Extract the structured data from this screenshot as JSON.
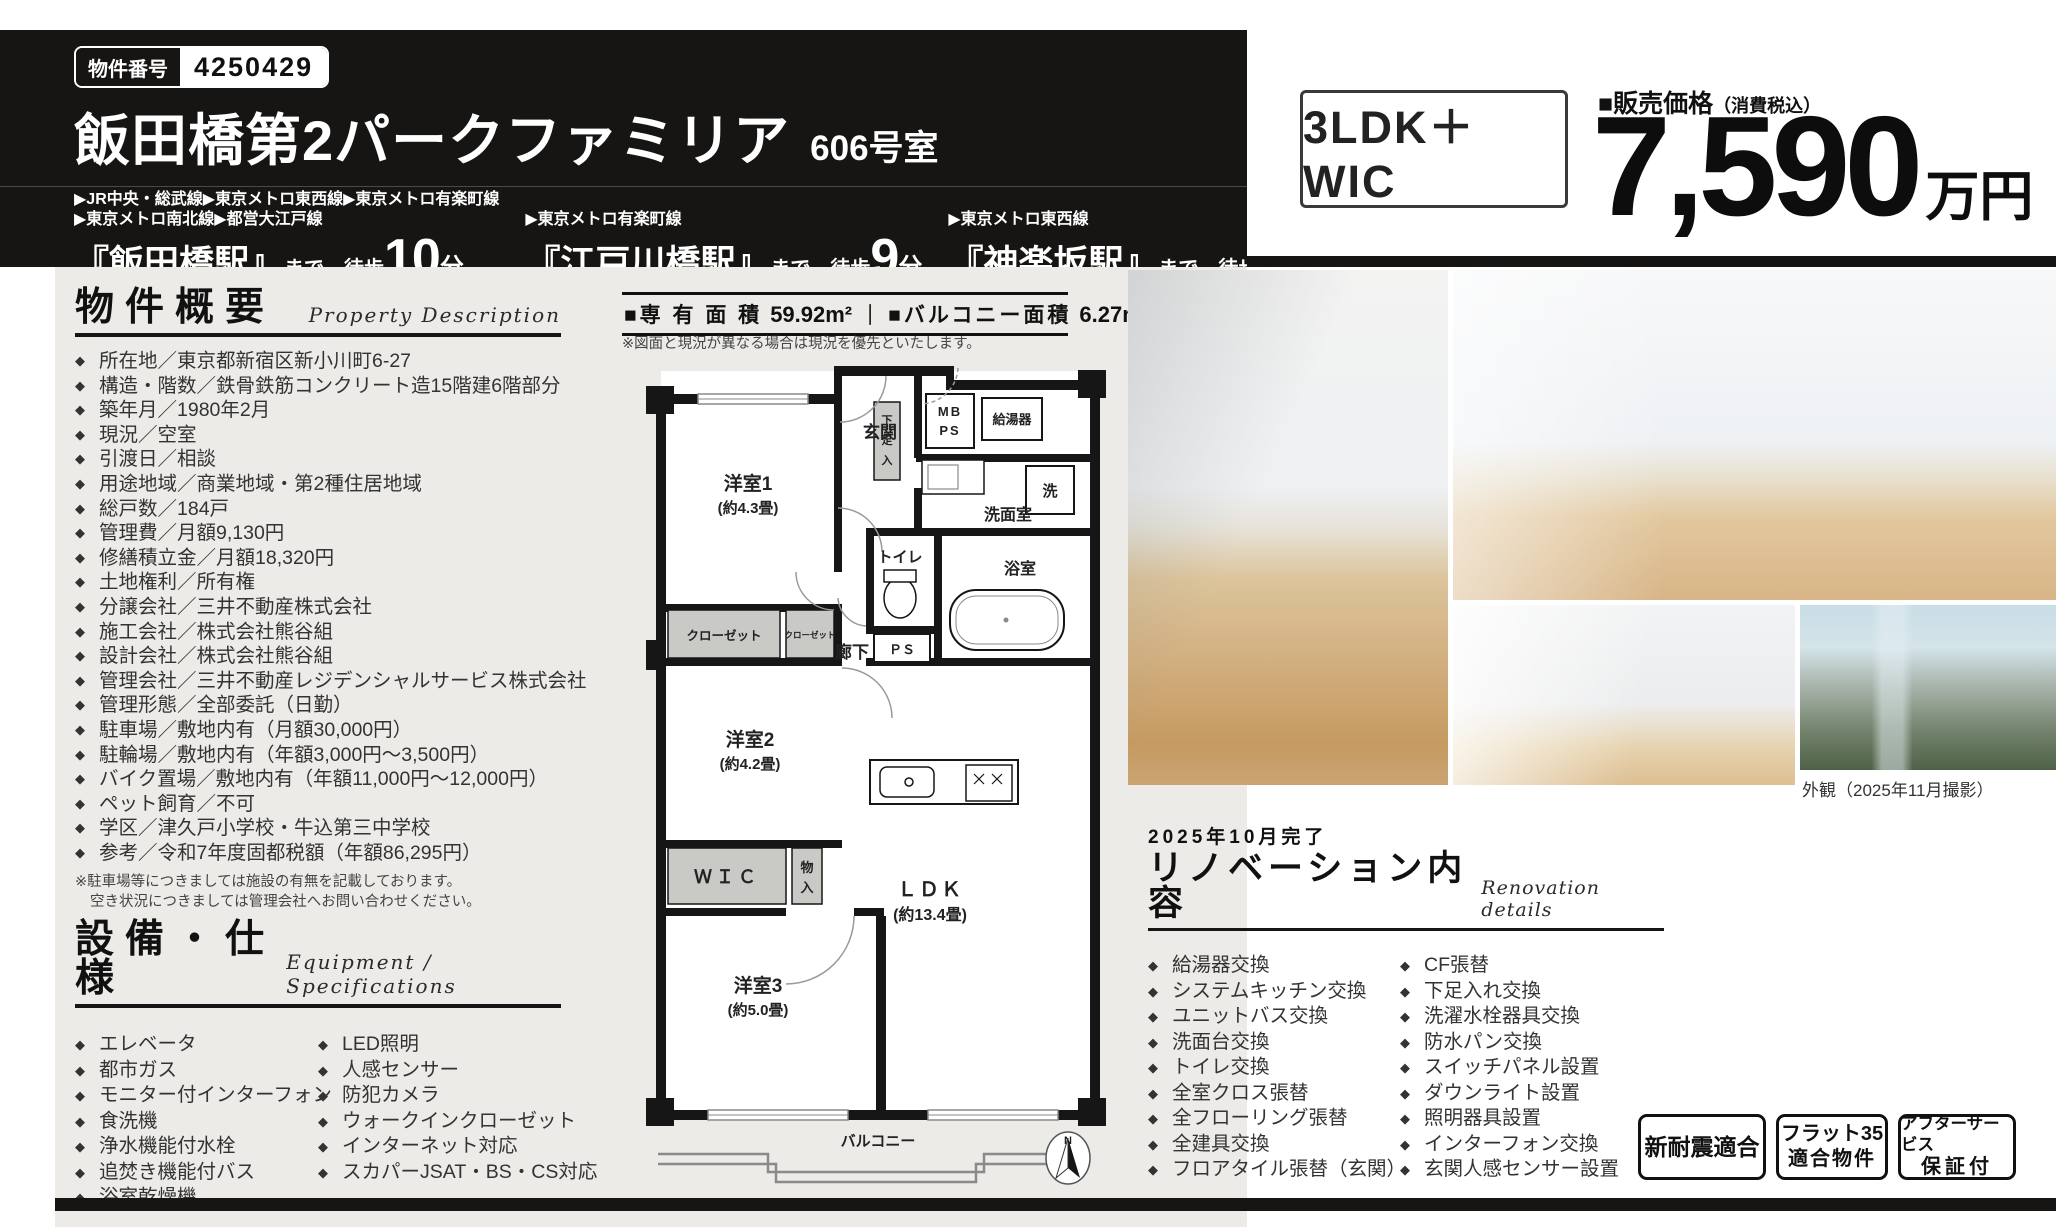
{
  "header": {
    "property_number_label": "物件番号",
    "property_number": "4250429",
    "title": "飯田橋第2パークファミリア",
    "unit": "606号室",
    "stations": [
      {
        "lines1": "▶JR中央・総武線▶東京メトロ東西線▶東京メトロ有楽町線",
        "lines2": "▶東京メトロ南北線▶都営大江戸線",
        "name": "『飯田橋駅』",
        "suffix": "まで…徒歩",
        "minutes": "10",
        "minutes_unit": "分"
      },
      {
        "lines1": "▶東京メトロ有楽町線",
        "lines2": "",
        "name": "『江戸川橋駅』",
        "suffix": "まで…徒歩",
        "minutes": "9",
        "minutes_unit": "分"
      },
      {
        "lines1": "▶東京メトロ東西線",
        "lines2": "",
        "name": "『神楽坂駅』",
        "suffix": "まで…徒歩",
        "minutes": "13",
        "minutes_unit": "分"
      }
    ]
  },
  "price": {
    "layout": "3LDK＋WIC",
    "label": "■販売価格",
    "label_note": "（消費税込）",
    "amount": "7,590",
    "unit": "万円"
  },
  "overview": {
    "heading": "物件概要",
    "heading_en": "Property Description",
    "items": [
      "所在地／東京都新宿区新小川町6-27",
      "構造・階数／鉄骨鉄筋コンクリート造15階建6階部分",
      "築年月／1980年2月",
      "現況／空室",
      "引渡日／相談",
      "用途地域／商業地域・第2種住居地域",
      "総戸数／184戸",
      "管理費／月額9,130円",
      "修繕積立金／月額18,320円",
      "土地権利／所有権",
      "分譲会社／三井不動産株式会社",
      "施工会社／株式会社熊谷組",
      "設計会社／株式会社熊谷組",
      "管理会社／三井不動産レジデンシャルサービス株式会社",
      "管理形態／全部委託（日勤）",
      "駐車場／敷地内有（月額30,000円）",
      "駐輪場／敷地内有（年額3,000円〜3,500円）",
      "バイク置場／敷地内有（年額11,000円〜12,000円）",
      "ペット飼育／不可",
      "学区／津久戸小学校・牛込第三中学校",
      "参考／令和7年度固都税額（年額86,295円）"
    ],
    "note1": "※駐車場等につきましては施設の有無を記載しております。",
    "note2": "空き状況につきましては管理会社へお問い合わせください。"
  },
  "equipment": {
    "heading": "設備・仕様",
    "heading_en": "Equipment / Specifications",
    "col1": [
      "エレベータ",
      "都市ガス",
      "モニター付インターフォン",
      "食洗機",
      "浄水機能付水栓",
      "追焚き機能付バス",
      "浴室乾燥機"
    ],
    "col2": [
      "LED照明",
      "人感センサー",
      "防犯カメラ",
      "ウォークインクローゼット",
      "インターネット対応",
      "スカパーJSAT・BS・CS対応"
    ]
  },
  "area_bar": {
    "label1": "■専 有 面 積",
    "value1": "59.92m²",
    "sep": "｜",
    "label2": "■バルコニー面積",
    "value2": "6.27m²",
    "note": "※図面と現況が異なる場合は現況を優先といたします。"
  },
  "floorplan": {
    "room1": "洋室1",
    "room1_size": "(約4.3畳)",
    "room2": "洋室2",
    "room2_size": "(約4.2畳)",
    "room3": "洋室3",
    "room3_size": "(約5.0畳)",
    "ldk": "ＬＤＫ",
    "ldk_size": "(約13.4畳)",
    "genkan": "玄関",
    "rouka": "廊下",
    "mb": "MB",
    "ps_top": "PS",
    "kyutoki": "給湯器",
    "laundry": "洗",
    "senmen": "洗面室",
    "toilet": "トイレ",
    "bath": "浴室",
    "ps": "ＰＳ",
    "closet1": "クローゼット",
    "closet2": "クローゼット",
    "wic": "ＷＩＣ",
    "chars": {
      "g1": "下",
      "g2": "足",
      "g3": "入",
      "m1": "物",
      "m2": "入"
    },
    "balcony": "バルコニー",
    "north": "N"
  },
  "photos": {
    "caption": "外観（2025年11月撮影）"
  },
  "renovation": {
    "date": "2025年10月完了",
    "heading": "リノベーション内容",
    "heading_en": "Renovation details",
    "col1": [
      "給湯器交換",
      "システムキッチン交換",
      "ユニットバス交換",
      "洗面台交換",
      "トイレ交換",
      "全室クロス張替",
      "全フローリング張替",
      "全建具交換",
      "フロアタイル張替（玄関）"
    ],
    "col2": [
      "CF張替",
      "下足入れ交換",
      "洗濯水栓器具交換",
      "防水パン交換",
      "スイッチパネル設置",
      "ダウンライト設置",
      "照明器具設置",
      "インターフォン交換",
      "玄関人感センサー設置"
    ]
  },
  "badges": [
    {
      "line1": "新耐震適合",
      "line2": ""
    },
    {
      "line1": "フラット35",
      "line2": "適合物件"
    },
    {
      "line1": "アフターサービス",
      "line2": "保証付"
    }
  ]
}
